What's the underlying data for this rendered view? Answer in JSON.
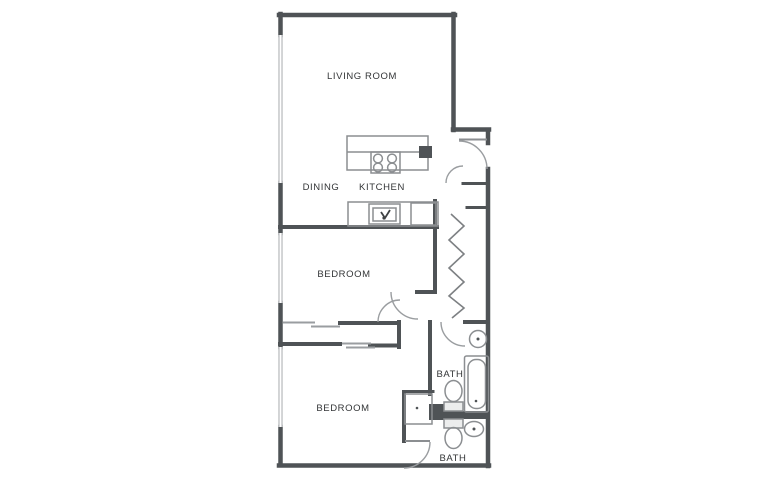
{
  "document": {
    "type": "apartment-floor-plan",
    "background": "#ffffff"
  },
  "colors": {
    "wall": "#4f5356",
    "window": "#c3c5c7",
    "fixture_line": "#8b8e91",
    "door_arc": "#9a9da0",
    "label_text": "#333537",
    "background": "#ffffff"
  },
  "rooms": [
    {
      "id": "living-room",
      "label": "LIVING ROOM"
    },
    {
      "id": "dining",
      "label": "DINING"
    },
    {
      "id": "kitchen",
      "label": "KITCHEN"
    },
    {
      "id": "bedroom-1",
      "label": "BEDROOM"
    },
    {
      "id": "bedroom-2",
      "label": "BEDROOM"
    },
    {
      "id": "bath-1",
      "label": "BATH"
    },
    {
      "id": "bath-2",
      "label": "BATH"
    }
  ],
  "fixtures": [
    "kitchen-island",
    "cooktop-burners",
    "kitchen-sink",
    "refrigerator",
    "kitchen-counter",
    "entry-door",
    "hall-closet-door",
    "bifold-closet-doors",
    "sliding-closet-doors",
    "bedroom-doors",
    "bathtub",
    "toilet-upper",
    "toilet-lower",
    "bath-sink-round",
    "bath-sink-oval",
    "vanity-cabinet",
    "left-wall-windows"
  ]
}
